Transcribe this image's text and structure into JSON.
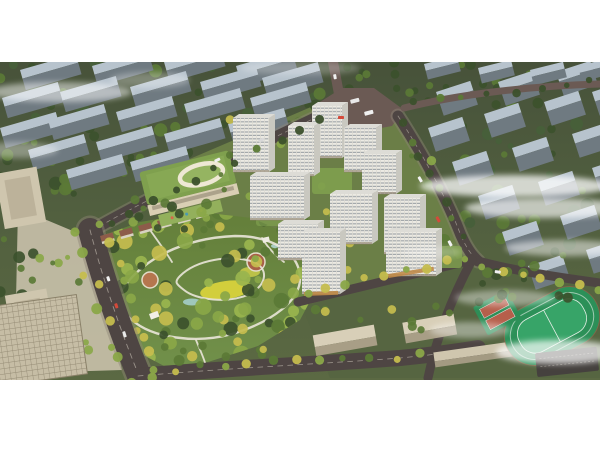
{
  "meta": {
    "alt": "aerial-architectural-rendering-of-residential-masterplan-with-central-park"
  },
  "palette": {
    "page_bg": "#ffffff",
    "ground_dark": "#47523a",
    "ground_mid": "#515f3f",
    "ground_light": "#5b6943",
    "slab_top": "#b7c3cd",
    "slab_side": "#6f7a81",
    "road": "#4e4543",
    "road_light": "#6b5a54",
    "tower_white": "#eceae3",
    "tower_stripe": "#a3a8ab",
    "tower_side": "#c9c8c0",
    "green_roof": "#7fa04e",
    "beige": "#cfc6ae",
    "beige_dark": "#a79d86",
    "park_green": "#647f3a",
    "tree_dark": "#3c512c",
    "tree_mid": "#5b7a36",
    "tree_light": "#8aa748",
    "tree_yellow": "#c5bd4e",
    "meadow_yellow": "#d8d23c",
    "path_white": "#eae6d9",
    "field_green": "#2c9058",
    "track_red": "#b35b49",
    "court_red": "#b65f4b",
    "fog_white": "#ffffff",
    "water": "#9fc7bc"
  },
  "scene": {
    "background_left_blocks": [
      [
        20,
        70
      ],
      [
        92,
        66
      ],
      [
        164,
        62
      ],
      [
        236,
        66
      ],
      [
        2,
        98
      ],
      [
        60,
        92
      ],
      [
        130,
        87
      ],
      [
        200,
        82
      ],
      [
        262,
        78
      ],
      [
        0,
        128
      ],
      [
        48,
        120
      ],
      [
        116,
        112
      ],
      [
        184,
        104
      ],
      [
        250,
        98
      ],
      [
        28,
        150
      ],
      [
        96,
        142
      ],
      [
        164,
        134
      ],
      [
        228,
        124
      ],
      [
        66,
        170
      ],
      [
        130,
        162
      ]
    ],
    "background_right_blocks": [
      [
        436,
        92
      ],
      [
        498,
        82
      ],
      [
        556,
        72
      ],
      [
        428,
        128
      ],
      [
        484,
        114
      ],
      [
        544,
        102
      ],
      [
        592,
        92
      ],
      [
        452,
        162
      ],
      [
        512,
        148
      ],
      [
        572,
        134
      ],
      [
        478,
        196
      ],
      [
        538,
        182
      ],
      [
        592,
        168
      ],
      [
        502,
        232
      ],
      [
        560,
        216
      ],
      [
        528,
        266
      ],
      [
        586,
        250
      ]
    ],
    "topright_blocks": [
      [
        424,
        64
      ],
      [
        478,
        68
      ],
      [
        530,
        70
      ],
      [
        578,
        66
      ]
    ],
    "towers": [
      [
        233,
        118,
        36,
        54
      ],
      [
        312,
        106,
        30,
        52
      ],
      [
        288,
        126,
        26,
        50
      ],
      [
        344,
        128,
        32,
        44
      ],
      [
        362,
        154,
        34,
        40
      ],
      [
        250,
        176,
        54,
        44
      ],
      [
        330,
        194,
        42,
        50
      ],
      [
        384,
        198,
        36,
        56
      ],
      [
        278,
        224,
        40,
        36
      ],
      [
        302,
        232,
        38,
        62
      ],
      [
        386,
        232,
        50,
        44
      ]
    ],
    "green_patches": [
      [
        312,
        168,
        40,
        26,
        0.9
      ],
      [
        354,
        148,
        28,
        18,
        0.7
      ],
      [
        430,
        246,
        32,
        22,
        0.85
      ],
      [
        256,
        210,
        30,
        16,
        0.7
      ]
    ],
    "houses": [
      [
        100,
        236
      ],
      [
        119,
        231
      ],
      [
        138,
        226
      ],
      [
        157,
        221
      ],
      [
        176,
        216
      ],
      [
        194,
        211
      ]
    ],
    "street_tree_lines": [
      {
        "from": [
          74,
          234
        ],
        "to": [
          128,
          380
        ],
        "count": 9,
        "r": 4.5,
        "jitter": 5,
        "colors": [
          "tree_yellow",
          "tree_light"
        ]
      },
      {
        "from": [
          104,
          226
        ],
        "to": [
          156,
          374
        ],
        "count": 9,
        "r": 4.5,
        "jitter": 5,
        "colors": [
          "tree_yellow",
          "tree_light"
        ]
      },
      {
        "from": [
          150,
          372
        ],
        "to": [
          420,
          354
        ],
        "count": 12,
        "r": 4,
        "jitter": 4,
        "colors": [
          "tree_yellow",
          "tree_light",
          "tree_mid"
        ]
      },
      {
        "from": [
          306,
          292
        ],
        "to": [
          466,
          258
        ],
        "count": 9,
        "r": 4,
        "jitter": 3,
        "colors": [
          "tree_yellow",
          "tree_light"
        ]
      },
      {
        "from": [
          404,
          124
        ],
        "to": [
          462,
          236
        ],
        "count": 8,
        "r": 4,
        "jitter": 3,
        "colors": [
          "tree_dark",
          "tree_mid"
        ]
      },
      {
        "from": [
          110,
          224
        ],
        "to": [
          322,
          118
        ],
        "count": 11,
        "r": 4,
        "jitter": 3,
        "colors": [
          "tree_dark",
          "tree_mid"
        ]
      },
      {
        "from": [
          484,
          268
        ],
        "to": [
          596,
          288
        ],
        "count": 7,
        "r": 4,
        "jitter": 3,
        "colors": [
          "tree_light",
          "tree_yellow"
        ]
      },
      {
        "from": [
          412,
          104
        ],
        "to": [
          592,
          82
        ],
        "count": 8,
        "r": 3.5,
        "jitter": 3,
        "colors": [
          "tree_dark",
          "tree_mid"
        ]
      }
    ],
    "scatter_areas": [
      {
        "layer": "bg-trees-left",
        "x": 0,
        "y": 62,
        "w": 330,
        "h": 66,
        "count": 48,
        "rmin": 3,
        "rmax": 7,
        "colors": [
          "tree_dark",
          "tree_mid",
          "#47603a"
        ]
      },
      {
        "layer": "bg-trees-left",
        "x": 0,
        "y": 128,
        "w": 210,
        "h": 66,
        "count": 30,
        "rmin": 3,
        "rmax": 7,
        "colors": [
          "tree_dark",
          "tree_mid"
        ]
      },
      {
        "layer": "bg-trees-right",
        "x": 428,
        "y": 62,
        "w": 172,
        "h": 52,
        "count": 22,
        "rmin": 3,
        "rmax": 6,
        "colors": [
          "tree_dark",
          "tree_mid"
        ]
      },
      {
        "layer": "bg-trees-right",
        "x": 440,
        "y": 118,
        "w": 160,
        "h": 146,
        "count": 42,
        "rmin": 3,
        "rmax": 7,
        "colors": [
          "tree_dark",
          "tree_mid",
          "#47603a"
        ]
      },
      {
        "layer": "school-trees",
        "x": 470,
        "y": 246,
        "w": 126,
        "h": 58,
        "count": 16,
        "rmin": 3,
        "rmax": 6,
        "colors": [
          "tree_dark",
          "tree_mid"
        ]
      },
      {
        "layer": "school-trees",
        "x": 306,
        "y": 306,
        "w": 150,
        "h": 24,
        "count": 10,
        "rmin": 3,
        "rmax": 5,
        "colors": [
          "tree_mid",
          "tree_yellow"
        ]
      },
      {
        "layer": "dev-trees",
        "x": 200,
        "y": 118,
        "w": 232,
        "h": 164,
        "count": 34,
        "rmin": 2.5,
        "rmax": 5,
        "colors": [
          "tree_light",
          "tree_mid",
          "tree_yellow"
        ]
      },
      {
        "layer": "kg-trees",
        "x": 128,
        "y": 196,
        "w": 104,
        "h": 38,
        "count": 13,
        "rmin": 3,
        "rmax": 6,
        "colors": [
          "tree_mid",
          "tree_dark",
          "tree_light"
        ]
      },
      {
        "layer": "plaza-trees",
        "x": 0,
        "y": 198,
        "w": 44,
        "h": 128,
        "count": 12,
        "rmin": 3,
        "rmax": 6,
        "colors": [
          "tree_dark",
          "tree_mid"
        ]
      },
      {
        "layer": "plaza-trees",
        "x": 30,
        "y": 230,
        "w": 60,
        "h": 120,
        "count": 10,
        "rmin": 2.5,
        "rmax": 5,
        "colors": [
          "tree_mid",
          "tree_light"
        ]
      },
      {
        "layer": "park-trees",
        "clip": true,
        "x": 96,
        "y": 208,
        "w": 224,
        "h": 160,
        "count": 95,
        "rmin": 3.5,
        "rmax": 8.5,
        "colors": [
          "tree_dark",
          "tree_mid",
          "tree_light",
          "tree_yellow",
          "#9ab54e"
        ]
      },
      {
        "layer": "south-trees",
        "x": 150,
        "y": 336,
        "w": 150,
        "h": 28,
        "count": 9,
        "rmin": 3,
        "rmax": 6,
        "colors": [
          "tree_mid",
          "tree_yellow"
        ]
      },
      {
        "layer": "topmid-trees",
        "x": 296,
        "y": 62,
        "w": 120,
        "h": 34,
        "count": 10,
        "rmin": 3,
        "rmax": 5,
        "colors": [
          "tree_dark",
          "tree_mid"
        ]
      }
    ],
    "fog": [
      [
        60,
        92,
        72,
        10,
        0.5
      ],
      [
        150,
        80,
        40,
        8,
        0.3
      ],
      [
        18,
        150,
        40,
        8,
        0.35
      ],
      [
        515,
        186,
        95,
        11,
        0.75
      ],
      [
        545,
        208,
        80,
        10,
        0.65
      ],
      [
        565,
        248,
        60,
        8,
        0.5
      ],
      [
        505,
        298,
        50,
        8,
        0.4
      ],
      [
        558,
        352,
        62,
        12,
        0.7
      ],
      [
        470,
        330,
        40,
        8,
        0.4
      ],
      [
        432,
        252,
        30,
        6,
        0.25
      ],
      [
        300,
        68,
        60,
        7,
        0.25
      ]
    ],
    "vehicles": [
      [
        350,
        100,
        9,
        4,
        "#e9e9e9",
        -15
      ],
      [
        364,
        112,
        9,
        4,
        "#f0f0f0",
        -15
      ],
      [
        338,
        116,
        6,
        3,
        "#d44a3a",
        0
      ],
      [
        420,
        176,
        6,
        3,
        "#f2f2f2",
        60
      ],
      [
        438,
        216,
        6,
        3,
        "#d44a3a",
        62
      ],
      [
        450,
        240,
        6,
        3,
        "#f2f2f2",
        62
      ],
      [
        109,
        276,
        5,
        3,
        "#f2f2f2",
        72
      ],
      [
        117,
        303,
        5,
        3,
        "#d44a3a",
        72
      ],
      [
        125,
        331,
        6,
        3,
        "#e9e9e9",
        72
      ],
      [
        214,
        160,
        6,
        3,
        "#f0f0f0",
        -26
      ],
      [
        258,
        140,
        6,
        3,
        "#d8d8d8",
        -26
      ],
      [
        495,
        270,
        6,
        3,
        "#f0f0f0",
        8
      ],
      [
        336,
        74,
        5,
        3,
        "#f0f0f0",
        80
      ]
    ]
  }
}
